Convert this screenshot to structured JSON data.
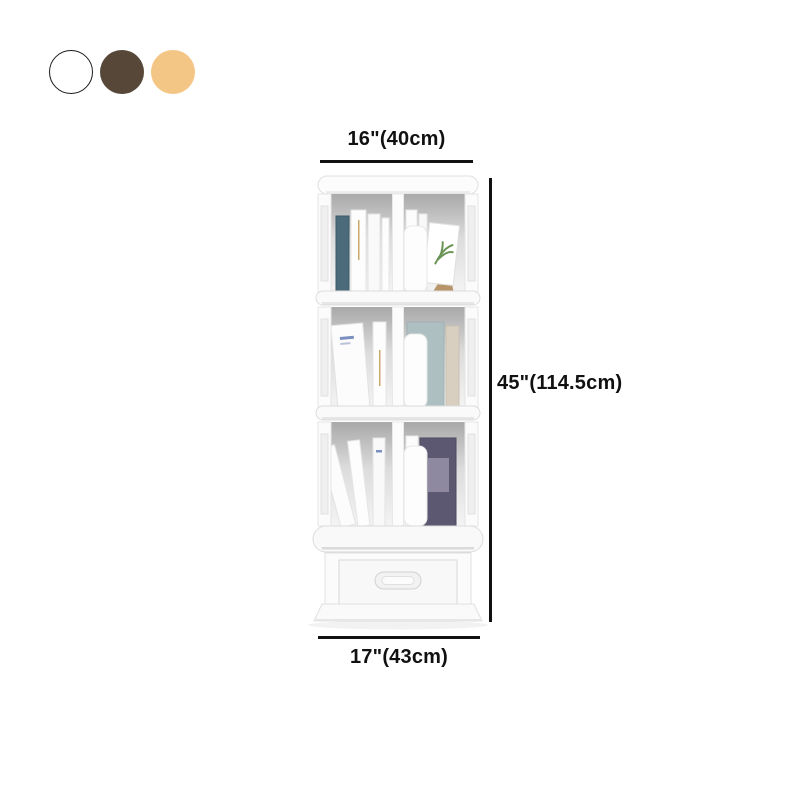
{
  "swatches": {
    "options": [
      {
        "name": "white",
        "color": "#ffffff",
        "border": "#1a1a1a"
      },
      {
        "name": "walnut-brown",
        "color": "#564738"
      },
      {
        "name": "light-tan",
        "color": "#f4c685"
      }
    ]
  },
  "dimensions": {
    "top_width": "16\"(40cm)",
    "height": "45\"(114.5cm)",
    "bottom_width": "17\"(43cm)"
  },
  "annotations": {
    "line_color": "#111111"
  },
  "illustration_colors": {
    "teal_book": "#4b6b7a",
    "purple_book": "#5d5871",
    "gray_book": "#aebfc2",
    "beige_book": "#d8cfc0",
    "plant_green": "#6a9455",
    "wood": "#b08b5a",
    "gold_text": "#c9a86a",
    "blue_text": "#7b8fc0"
  }
}
